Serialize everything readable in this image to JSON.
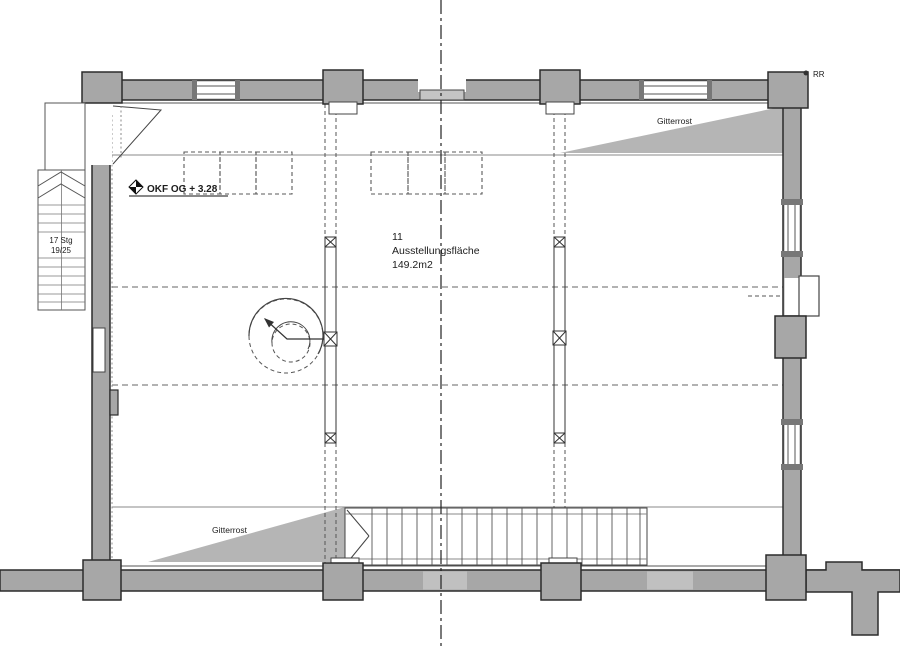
{
  "drawing": {
    "labels": {
      "level_marker": "OKF OG + 3.28",
      "room_number": "11",
      "room_name": "Ausstellungsfläche",
      "room_area": "149.2m2",
      "grating_top": "Gitterrost",
      "grating_bottom": "Gitterrost",
      "stair_steps": "17 Stg",
      "stair_dim": "19/25",
      "rr_marker": "RR"
    },
    "colors": {
      "wall_fill": "#a7a7a7",
      "wall_outline": "#2b2b2b",
      "grating_fill": "#b5b5b5",
      "opening_fill": "#c4c4c4",
      "thin_line": "#8a8a8a",
      "dash_line": "#555555",
      "text": "#1c1c1c"
    }
  }
}
